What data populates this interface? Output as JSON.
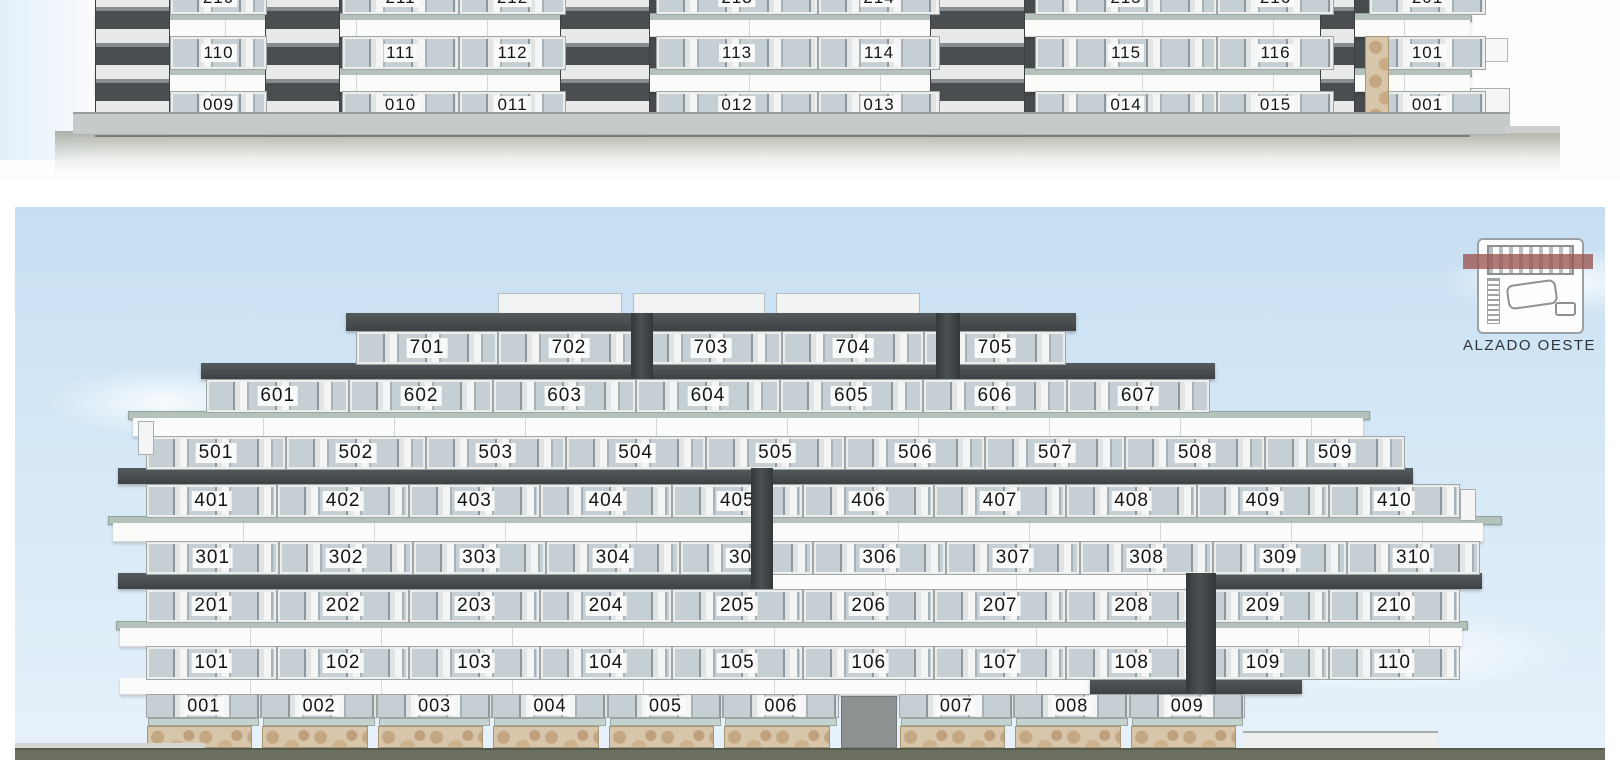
{
  "upper_elevation": {
    "floors": [
      {
        "id": "floor-2",
        "units": [
          "210",
          "211",
          "212",
          "213",
          "214",
          "215",
          "216",
          "201"
        ]
      },
      {
        "id": "floor-1",
        "units": [
          "110",
          "111",
          "112",
          "113",
          "114",
          "115",
          "116",
          "101"
        ]
      },
      {
        "id": "floor-0",
        "units": [
          "009",
          "010",
          "011",
          "012",
          "013",
          "014",
          "015",
          "001"
        ]
      }
    ]
  },
  "west_elevation": {
    "key_plan": {
      "label": "ALZADO OESTE"
    },
    "floors": [
      {
        "id": "floor-7",
        "units": [
          "701",
          "702",
          "703",
          "704",
          "705"
        ]
      },
      {
        "id": "floor-6",
        "units": [
          "601",
          "602",
          "603",
          "604",
          "605",
          "606",
          "607"
        ]
      },
      {
        "id": "floor-5",
        "units": [
          "501",
          "502",
          "503",
          "504",
          "505",
          "506",
          "507",
          "508",
          "509"
        ]
      },
      {
        "id": "floor-4",
        "units": [
          "401",
          "402",
          "403",
          "404",
          "405",
          "406",
          "407",
          "408",
          "409",
          "410"
        ]
      },
      {
        "id": "floor-3",
        "units": [
          "301",
          "302",
          "303",
          "304",
          "305",
          "306",
          "307",
          "308",
          "309",
          "310"
        ]
      },
      {
        "id": "floor-2",
        "units": [
          "201",
          "202",
          "203",
          "204",
          "205",
          "206",
          "207",
          "208",
          "209",
          "210"
        ]
      },
      {
        "id": "floor-1",
        "units": [
          "101",
          "102",
          "103",
          "104",
          "105",
          "106",
          "107",
          "108",
          "109",
          "110"
        ]
      },
      {
        "id": "floor-0",
        "units": [
          "001",
          "002",
          "003",
          "004",
          "005",
          "006",
          "007",
          "008",
          "009"
        ]
      }
    ]
  },
  "colors": {
    "sky": "#cbe2f4",
    "facade_white": "#f5f5f3",
    "dark_band": "#45494b",
    "slab_glass": "#b5c2bc",
    "stone": "#d3bfa2",
    "ground": "#676c5f",
    "keyplan_accent": "#9a5451",
    "label_text": "#151515"
  }
}
